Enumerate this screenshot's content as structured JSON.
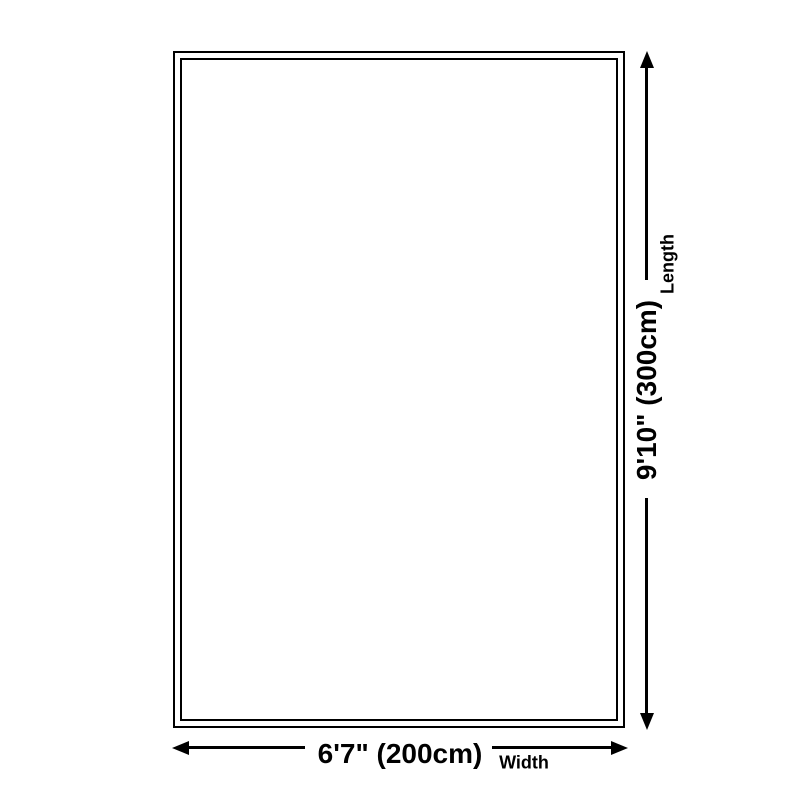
{
  "diagram": {
    "length": {
      "value": "9'10\" (300cm)",
      "label": "Length"
    },
    "width": {
      "value": "6'7\" (200cm)",
      "label": "Width"
    },
    "colors": {
      "line": "#000000",
      "text": "#000000",
      "background": "#ffffff"
    },
    "icons": {
      "arrowhead_up": "▲",
      "arrowhead_down": "▼",
      "arrowhead_left": "◀",
      "arrowhead_right": "▶"
    }
  }
}
